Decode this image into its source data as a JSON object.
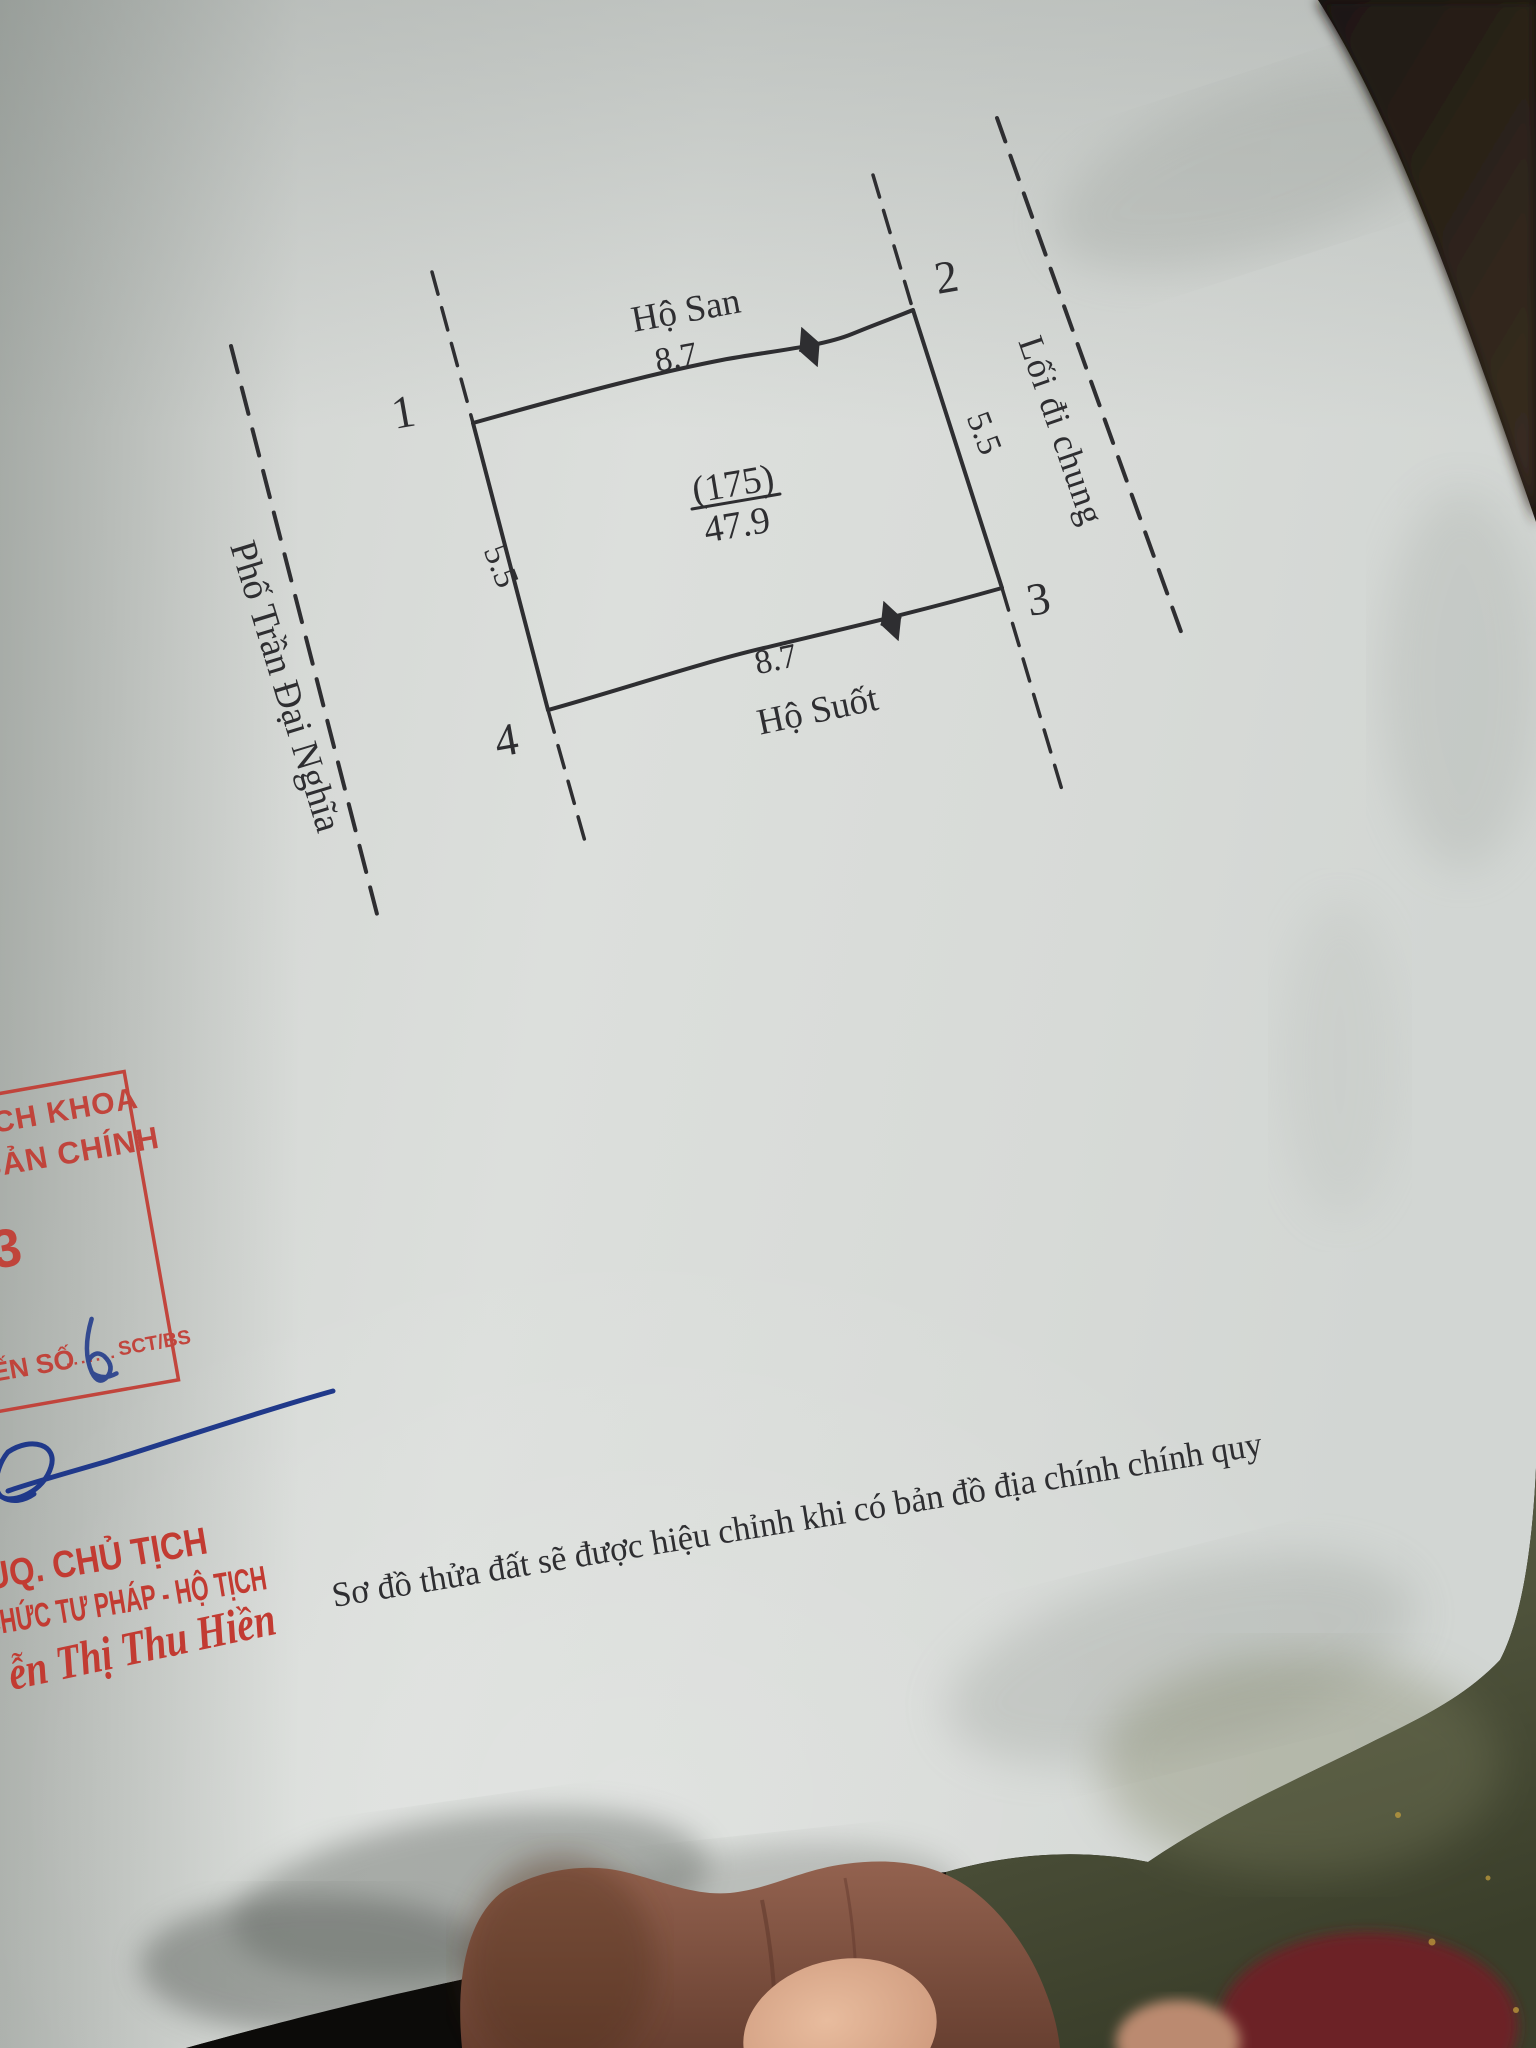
{
  "document_type": "land plot sketch (photographed paper)",
  "diagram": {
    "street_label": "Phố Trần Đại Nghĩa",
    "alley_label": "Lối đi chung",
    "neighbor_top": "Hộ San",
    "neighbor_bottom": "Hộ Suốt",
    "corner_1": "1",
    "corner_2": "2",
    "corner_3": "3",
    "corner_4": "4",
    "dim_top": "8.7",
    "dim_bottom": "8.7",
    "dim_left": "5.5",
    "dim_right": "5.5",
    "plot_number": "(175)",
    "plot_area": "47.9"
  },
  "note": "Sơ đồ thửa đất sẽ được hiệu chỉnh khi có bản đồ địa chính chính quy",
  "stamp": {
    "line1": "ÁCH KHOA",
    "line2": "I BẢN CHÍNH",
    "number": "3",
    "footer_left": "ẾN SỐ",
    "footer_right": "SCT/BS"
  },
  "signature_block": {
    "title1": "UQ. CHỦ TỊCH",
    "title2": "CHỨC TƯ PHÁP - HỘ TỊCH",
    "name": "ễn Thị Thu Hiền"
  },
  "colors": {
    "paper": "#d9dcd9",
    "ink": "#2e2e31",
    "stamp_red": "#c23b32",
    "pen_blue": "#20398a",
    "backdrop_dark": "#16120d",
    "backdrop_olive": "#565a40",
    "backdrop_maroon": "#6c2027",
    "skin_dark": "#8a5a49",
    "skin_light": "#d7a88c"
  }
}
